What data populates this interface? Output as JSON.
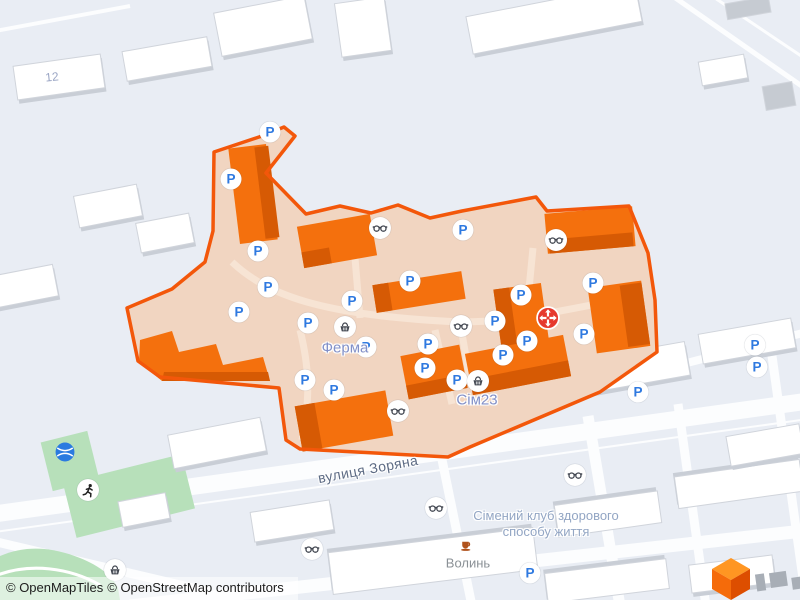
{
  "labels": {
    "house_number": "12",
    "ferma": "Ферма",
    "sim23": "Сім23",
    "street": "вулиця Зоряна",
    "club_line1": "Сімений клуб здорового",
    "club_line2": "способу життя",
    "volyn": "Волинь"
  },
  "attribution": {
    "openmaptiles": "© OpenMapTiles",
    "osm": "© OpenStreetMap contributors"
  },
  "icons": {
    "parking_glyph": "P"
  },
  "colors": {
    "background": "#e9edf4",
    "road": "#fcfdfe",
    "building": "#ffffff",
    "building_shadow": "#c9ced6",
    "selected_area_fill": "#f1d5c1",
    "selected_area_border": "#f3570a",
    "orange_building": "#f4700d",
    "orange_building_dark": "#d65a04",
    "parking_blue": "#2e79e0",
    "green_area": "#b7e0ba",
    "poi_label_blue": "#8290c8",
    "street_label": "#5d6b84",
    "red_marker": "#e6392e",
    "logo_orange": "#ff9622"
  }
}
